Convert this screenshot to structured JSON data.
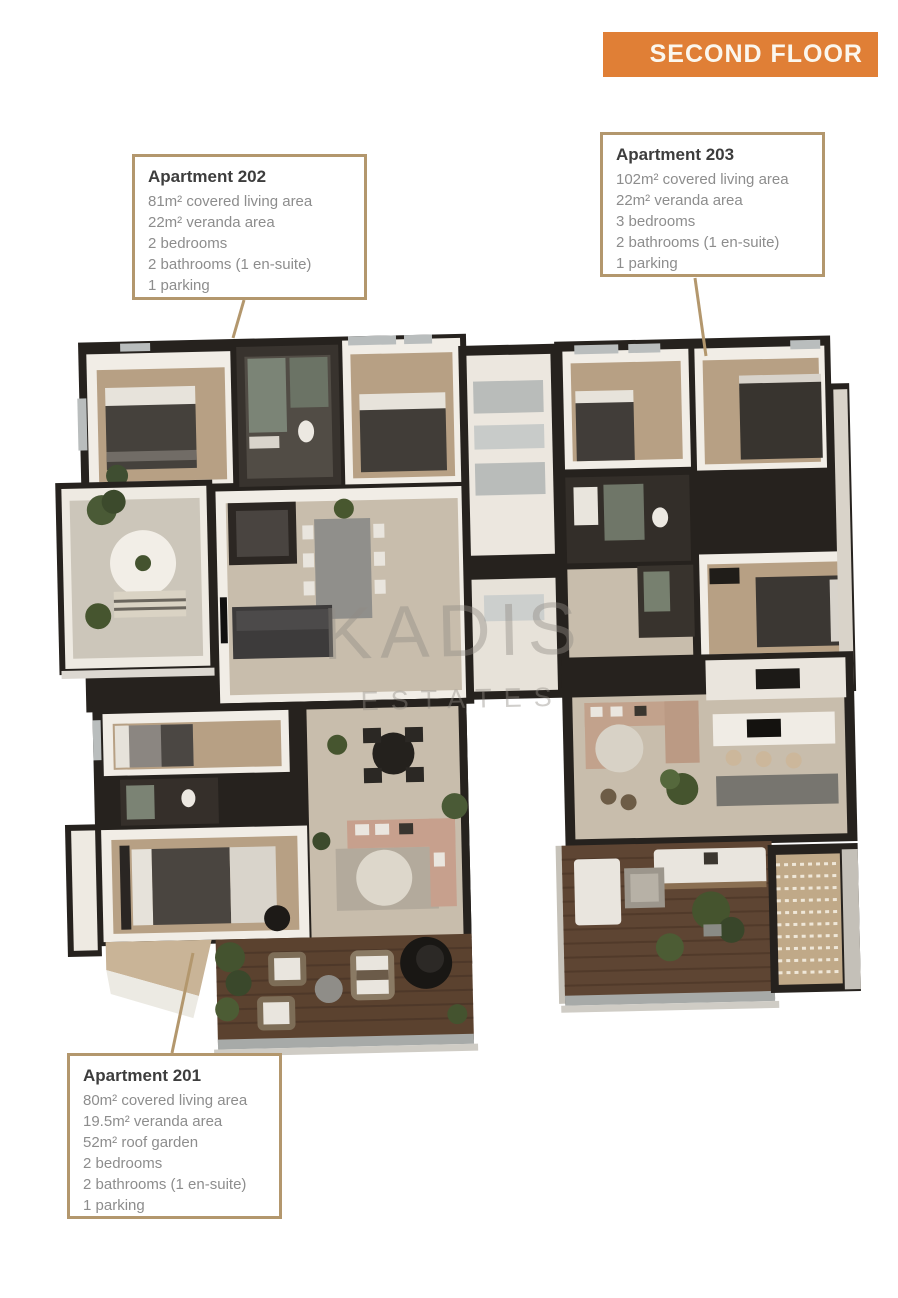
{
  "banner": {
    "label": "SECOND FLOOR"
  },
  "watermark": {
    "line1": "KADIS",
    "line2": "ESTATES"
  },
  "apartments": [
    {
      "id": "202",
      "title": "Apartment 202",
      "lines": [
        "81m² covered living area",
        "22m² veranda area",
        "2 bedrooms",
        "2 bathrooms (1 en-suite)",
        "1 parking"
      ]
    },
    {
      "id": "203",
      "title": "Apartment 203",
      "lines": [
        "102m² covered living area",
        "22m² veranda area",
        "3 bedrooms",
        "2 bathrooms (1 en-suite)",
        "1 parking"
      ]
    },
    {
      "id": "201",
      "title": "Apartment 201",
      "lines": [
        "80m² covered living area",
        "19.5m² veranda area",
        "52m² roof garden",
        "2 bedrooms",
        "2 bathrooms (1 en-suite)",
        "1 parking"
      ]
    }
  ],
  "colors": {
    "banner_bg": "#e07f36",
    "banner_text": "#fbf7ee",
    "callout_border": "#b3976d",
    "callout_title": "#3d3d3d",
    "callout_body": "#8d8d8d",
    "leader_line": "#b3976d",
    "watermark": "#918c85"
  }
}
